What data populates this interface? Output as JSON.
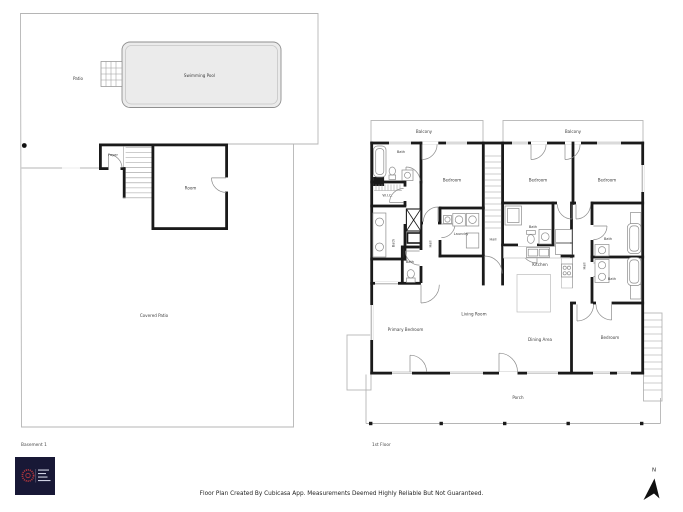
{
  "sheet": {
    "background": "#ffffff",
    "wall_color": "#1a1a1a",
    "pool_fill": "#ebebeb",
    "logo_bg": "#181836",
    "logo_accent": "#b5373d"
  },
  "basement": {
    "title": "Basement 1",
    "rooms": {
      "patio": "Patio",
      "swimming_pool": "Swimming Pool",
      "foyer": "Foyer",
      "room": "Room",
      "covered_patio": "Covered Patio"
    }
  },
  "first_floor": {
    "title": "1st Floor",
    "rooms": {
      "balcony": "Balcony",
      "bedroom": "Bedroom",
      "primary_bedroom": "Primary Bedroom",
      "bath": "Bath",
      "wic": "W.I.C.",
      "laundry": "Laundry",
      "hall": "Hall",
      "kitchen": "Kitchen",
      "living_room": "Living Room",
      "dining_area": "Dining Area",
      "porch": "Porch"
    }
  },
  "footer": {
    "disclaimer": "Floor Plan Created By Cubicasa App. Measurements Deemed Highly Reliable But Not Guaranteed."
  },
  "compass": {
    "north_label": "N"
  }
}
